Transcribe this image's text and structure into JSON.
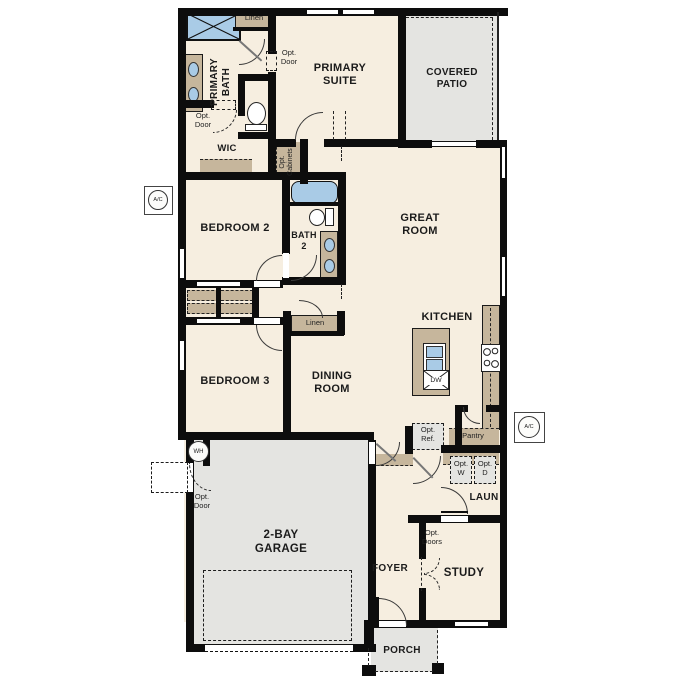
{
  "rooms": {
    "primary_suite": "PRIMARY\nSUITE",
    "primary_bath": "PRIMARY\nBATH",
    "covered_patio": "COVERED\nPATIO",
    "wic": "WIC",
    "bedroom2": "BEDROOM 2",
    "bath2": "BATH\n2",
    "great_room": "GREAT\nROOM",
    "kitchen": "KITCHEN",
    "bedroom3": "BEDROOM 3",
    "dining_room": "DINING\nROOM",
    "garage": "2-BAY\nGARAGE",
    "foyer": "FOYER",
    "study": "STUDY",
    "laundry": "LAUN",
    "porch": "PORCH"
  },
  "closets": {
    "linen_top": "Linen",
    "linen_hall": "Linen",
    "pantry": "Pantry"
  },
  "options": {
    "opt_door": "Opt.\nDoor",
    "opt_doors": "Opt.\nDoors",
    "opt_cabinets": "Opt.\nCabinets",
    "opt_ref": "Opt.\nRef.",
    "opt_w": "Opt.\nW",
    "opt_d": "Opt.\nD"
  },
  "equipment": {
    "ac": "A/C",
    "wh": "WH",
    "dw": "DW"
  },
  "colors": {
    "wall": "#0d0d0d",
    "floor": "#f6eee0",
    "concrete": "#e4e4e1",
    "casework": "#c6b69c",
    "fixture_blue": "#a9cbe6"
  }
}
